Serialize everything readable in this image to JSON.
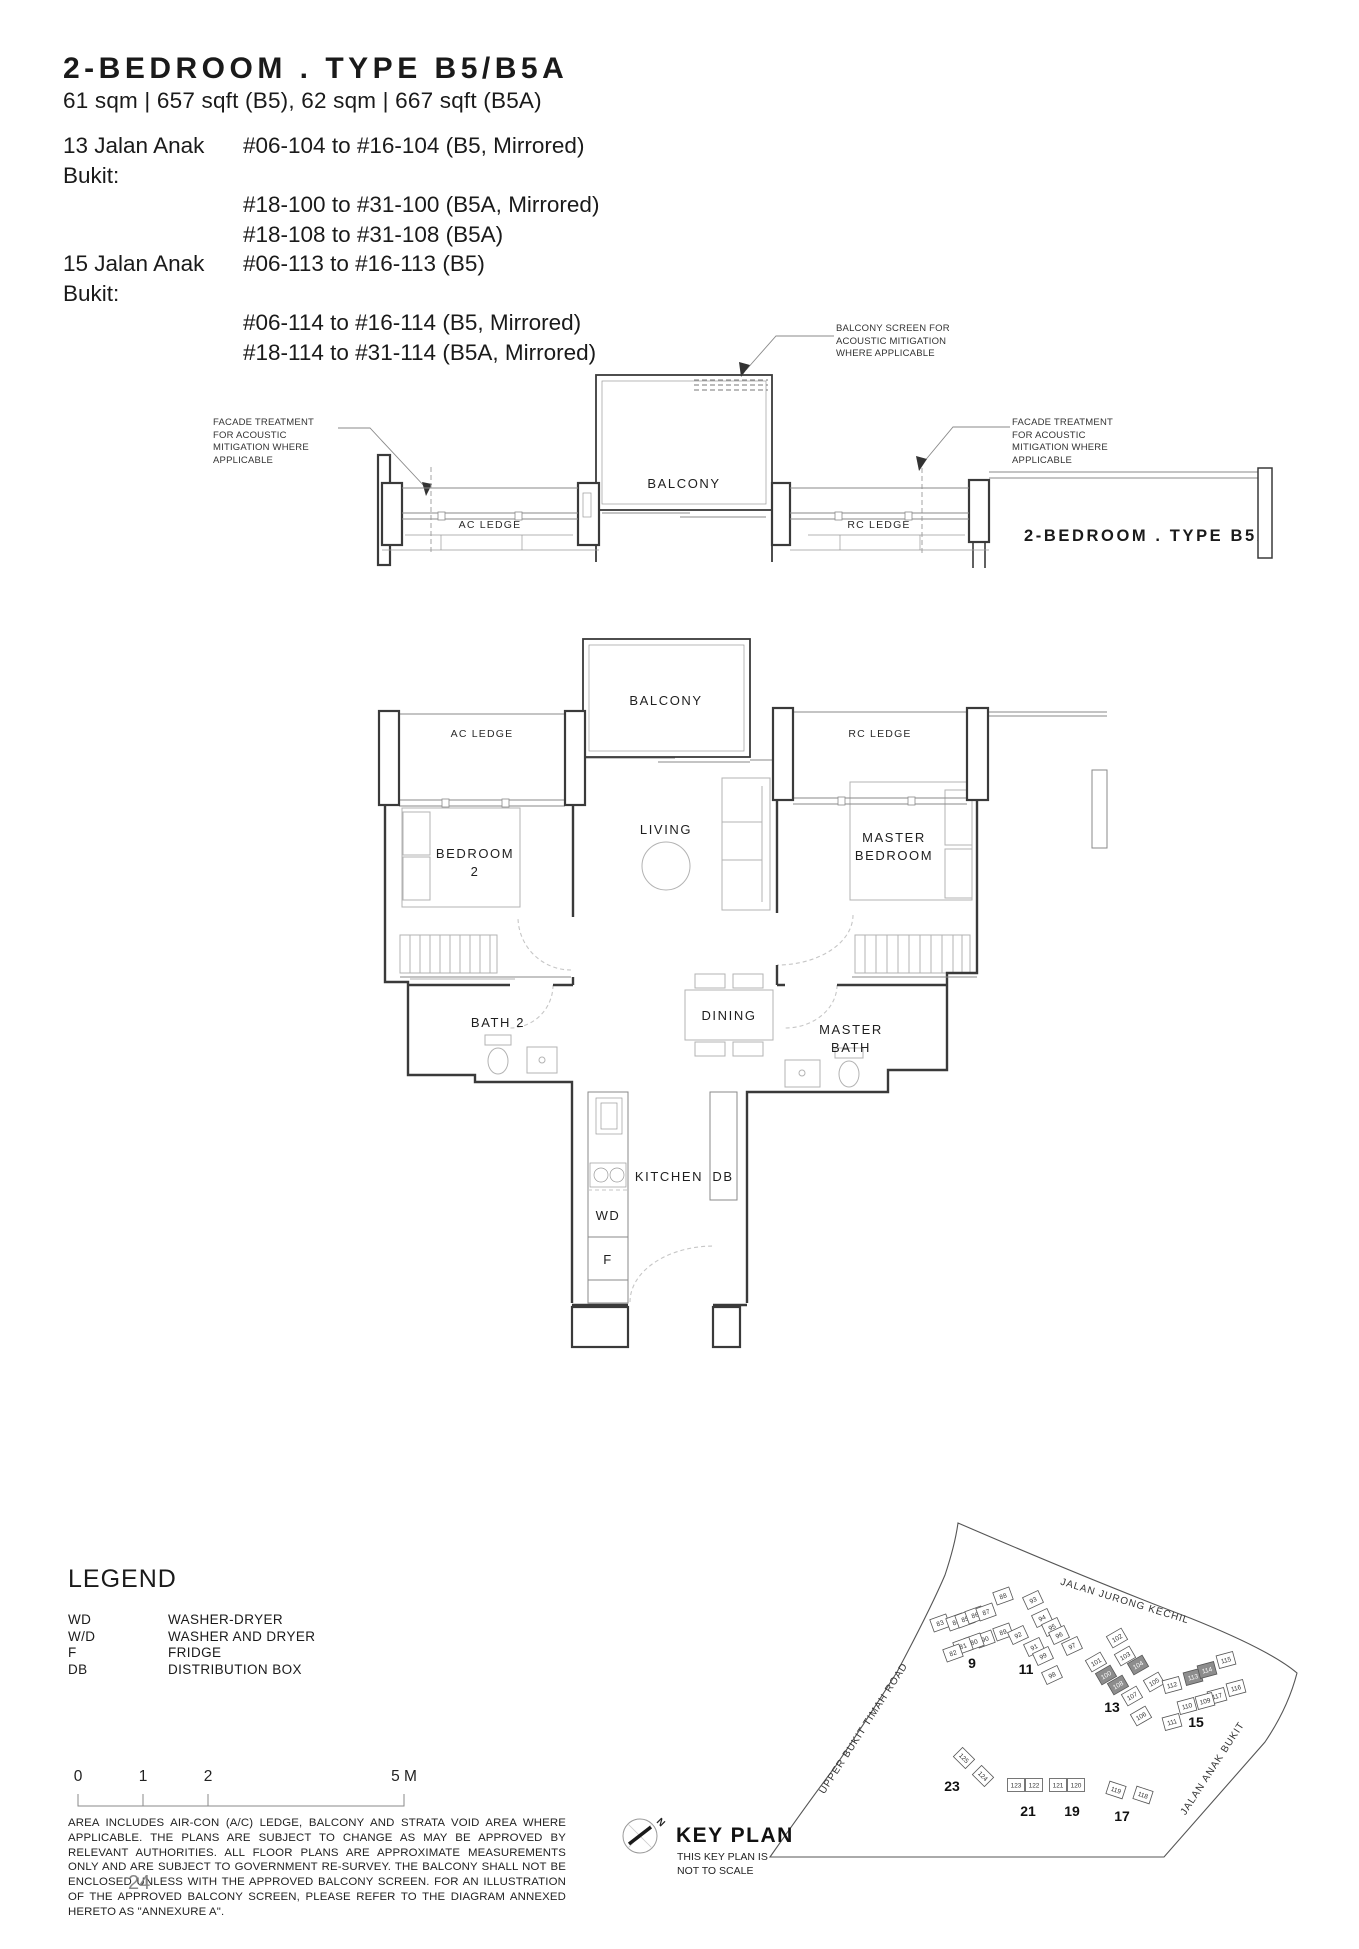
{
  "header": {
    "title": "2-BEDROOM . TYPE B5/B5A",
    "subtitle": "61 sqm | 657 sqft (B5), 62 sqm | 667 sqft (B5A)",
    "address_rows": [
      {
        "label": "13 Jalan Anak Bukit:",
        "text": "#06-104 to #16-104 (B5, Mirrored)"
      },
      {
        "label": "",
        "text": "#18-100 to #31-100 (B5A, Mirrored)"
      },
      {
        "label": "",
        "text": "#18-108 to #31-108 (B5A)"
      },
      {
        "label": "15 Jalan Anak Bukit:",
        "text": "#06-113 to #16-113 (B5)"
      },
      {
        "label": "",
        "text": "#06-114 to #16-114 (B5, Mirrored)"
      },
      {
        "label": "",
        "text": "#18-114 to #31-114 (B5A, Mirrored)"
      }
    ]
  },
  "annotations": {
    "facade_left": "FACADE TREATMENT FOR ACOUSTIC MITIGATION WHERE APPLICABLE",
    "balcony_screen": "BALCONY SCREEN FOR ACOUSTIC MITIGATION WHERE APPLICABLE",
    "facade_right": "FACADE TREATMENT FOR ACOUSTIC MITIGATION WHERE APPLICABLE",
    "type_b5a_label": "2-BEDROOM . TYPE B5A"
  },
  "plan_upper": {
    "balcony": "BALCONY",
    "ac_ledge": "AC LEDGE",
    "rc_ledge": "RC LEDGE"
  },
  "plan_main": {
    "balcony": "BALCONY",
    "ac_ledge": "AC LEDGE",
    "rc_ledge": "RC LEDGE",
    "living": "LIVING",
    "bedroom2_line1": "BEDROOM",
    "bedroom2_line2": "2",
    "master_line1": "MASTER",
    "master_line2": "BEDROOM",
    "bath2": "BATH 2",
    "dining": "DINING",
    "masterbath_line1": "MASTER",
    "masterbath_line2": "BATH",
    "kitchen": "KITCHEN",
    "db": "DB",
    "wd": "WD",
    "f": "F"
  },
  "legend": {
    "title": "LEGEND",
    "items": [
      {
        "abbr": "WD",
        "desc": "WASHER-DRYER"
      },
      {
        "abbr": "W/D",
        "desc": "WASHER AND DRYER"
      },
      {
        "abbr": "F",
        "desc": "FRIDGE"
      },
      {
        "abbr": "DB",
        "desc": "DISTRIBUTION BOX"
      }
    ]
  },
  "scale_bar": {
    "labels": [
      "0",
      "1",
      "2",
      "5 M"
    ]
  },
  "disclaimer": "AREA INCLUDES AIR-CON (A/C) LEDGE, BALCONY AND STRATA VOID AREA WHERE APPLICABLE. THE PLANS ARE SUBJECT TO CHANGE AS MAY BE APPROVED BY RELEVANT AUTHORITIES. ALL FLOOR PLANS ARE APPROXIMATE MEASUREMENTS ONLY AND ARE SUBJECT TO GOVERNMENT RE-SURVEY. THE BALCONY SHALL NOT BE ENCLOSED UNLESS WITH THE APPROVED BALCONY SCREEN. FOR AN ILLUSTRATION OF THE APPROVED BALCONY SCREEN, PLEASE REFER TO THE DIAGRAM ANNEXED HERETO AS \"ANNEXURE A\".",
  "page_number": "24",
  "keyplan": {
    "title": "KEY PLAN",
    "note_line1": "THIS KEY PLAN IS",
    "note_line2": "NOT TO SCALE",
    "north_label": "N",
    "roads": [
      {
        "name": "JALAN JURONG KECHIL",
        "x": 504,
        "y": 124,
        "rot": 17
      },
      {
        "name": "UPPER BUKIT TIMAH ROAD",
        "x": 246,
        "y": 250,
        "rot": -57
      },
      {
        "name": "JALAN ANAK BUKIT",
        "x": 595,
        "y": 290,
        "rot": -57
      }
    ],
    "highlight_color": "#8d8d8d",
    "blocks": [
      {
        "label": "9",
        "lx": 352,
        "ly": 188,
        "rot": -20,
        "units": [
          {
            "n": "83",
            "x": 320,
            "y": 143
          },
          {
            "n": "84",
            "x": 336,
            "y": 142
          },
          {
            "n": "85",
            "x": 345,
            "y": 139
          },
          {
            "n": "86",
            "x": 355,
            "y": 135
          },
          {
            "n": "87",
            "x": 366,
            "y": 132
          },
          {
            "n": "88",
            "x": 383,
            "y": 116
          },
          {
            "n": "89",
            "x": 383,
            "y": 152
          },
          {
            "n": "90",
            "x": 365,
            "y": 159
          },
          {
            "n": "80",
            "x": 354,
            "y": 162
          },
          {
            "n": "81",
            "x": 343,
            "y": 166
          },
          {
            "n": "82",
            "x": 333,
            "y": 173
          }
        ]
      },
      {
        "label": "11",
        "lx": 406,
        "ly": 194,
        "rot": -25,
        "units": [
          {
            "n": "93",
            "x": 413,
            "y": 120
          },
          {
            "n": "94",
            "x": 422,
            "y": 138
          },
          {
            "n": "95",
            "x": 432,
            "y": 147
          },
          {
            "n": "96",
            "x": 439,
            "y": 155
          },
          {
            "n": "97",
            "x": 452,
            "y": 166
          },
          {
            "n": "92",
            "x": 398,
            "y": 155
          },
          {
            "n": "91",
            "x": 414,
            "y": 167
          },
          {
            "n": "99",
            "x": 423,
            "y": 176
          },
          {
            "n": "98",
            "x": 432,
            "y": 195
          }
        ]
      },
      {
        "label": "13",
        "lx": 492,
        "ly": 232,
        "rot": -30,
        "units": [
          {
            "n": "102",
            "x": 497,
            "y": 158
          },
          {
            "n": "103",
            "x": 505,
            "y": 176
          },
          {
            "n": "104",
            "x": 518,
            "y": 185,
            "dark": true
          },
          {
            "n": "101",
            "x": 476,
            "y": 182
          },
          {
            "n": "100",
            "x": 486,
            "y": 195,
            "dark": true
          },
          {
            "n": "108",
            "x": 498,
            "y": 205,
            "dark": true
          },
          {
            "n": "107",
            "x": 512,
            "y": 216
          },
          {
            "n": "106",
            "x": 521,
            "y": 236
          },
          {
            "n": "105",
            "x": 534,
            "y": 202
          }
        ]
      },
      {
        "label": "15",
        "lx": 576,
        "ly": 247,
        "rot": -15,
        "units": [
          {
            "n": "112",
            "x": 552,
            "y": 205
          },
          {
            "n": "113",
            "x": 573,
            "y": 197,
            "dark": true
          },
          {
            "n": "114",
            "x": 587,
            "y": 190,
            "dark": true
          },
          {
            "n": "115",
            "x": 606,
            "y": 180
          },
          {
            "n": "116",
            "x": 616,
            "y": 208
          },
          {
            "n": "117",
            "x": 597,
            "y": 216
          },
          {
            "n": "109",
            "x": 585,
            "y": 221
          },
          {
            "n": "110",
            "x": 567,
            "y": 226
          },
          {
            "n": "111",
            "x": 552,
            "y": 242
          }
        ]
      },
      {
        "label": "23",
        "lx": 332,
        "ly": 311,
        "rot": 45,
        "units": [
          {
            "n": "125",
            "x": 344,
            "y": 278
          },
          {
            "n": "124",
            "x": 363,
            "y": 296
          }
        ]
      },
      {
        "label": "21",
        "lx": 408,
        "ly": 336,
        "rot": 0,
        "units": [
          {
            "n": "123",
            "x": 396,
            "y": 305
          },
          {
            "n": "122",
            "x": 414,
            "y": 305
          }
        ]
      },
      {
        "label": "19",
        "lx": 452,
        "ly": 336,
        "rot": 0,
        "units": [
          {
            "n": "121",
            "x": 438,
            "y": 305
          },
          {
            "n": "120",
            "x": 456,
            "y": 305
          }
        ]
      },
      {
        "label": "17",
        "lx": 502,
        "ly": 341,
        "rot": 18,
        "units": [
          {
            "n": "119",
            "x": 496,
            "y": 310
          },
          {
            "n": "118",
            "x": 523,
            "y": 315
          }
        ]
      }
    ]
  }
}
